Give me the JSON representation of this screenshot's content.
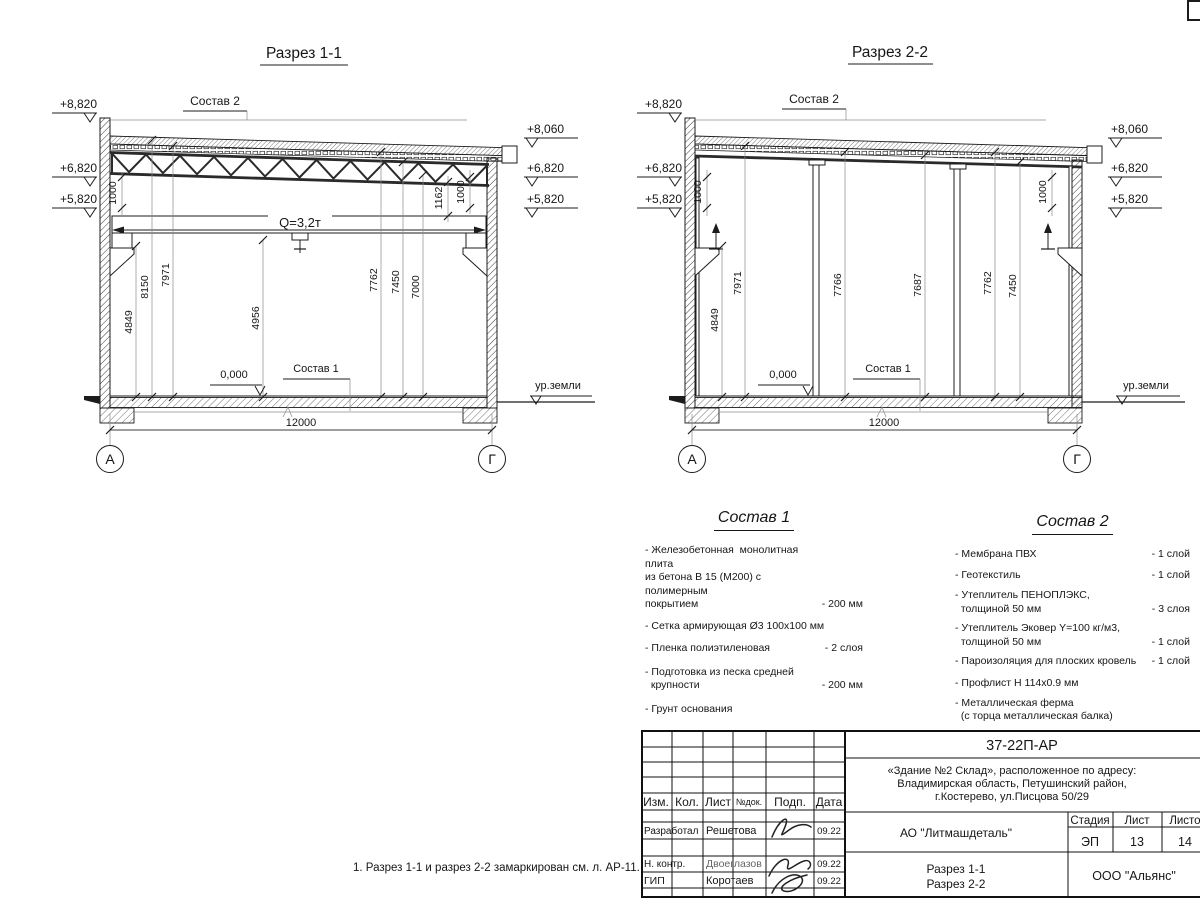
{
  "note": "1. Разрез 1-1 и разрез 2-2 замаркирован см. л. АР-11.",
  "s1": {
    "title": "Разрез 1-1",
    "elev": {
      "l1": "+8,820",
      "l2": "+6,820",
      "l3": "+5,820",
      "r1": "+8,060",
      "r2": "+6,820",
      "r3": "+5,820"
    },
    "labels": {
      "sostav2": "Состав 2",
      "sostav1": "Состав 1",
      "crane": "Q=3,2т",
      "zero": "0,000",
      "ground": "ур.земли",
      "span": "12000",
      "axis_a": "А",
      "axis_g": "Г"
    },
    "dims": {
      "wl": "1000",
      "wr1": "1162",
      "wr2": "1000",
      "h1": "4849",
      "h2": "8150",
      "h3": "7971",
      "h4": "4956",
      "h5": "7762",
      "h6": "7450",
      "h7": "7000"
    }
  },
  "s2": {
    "title": "Разрез 2-2",
    "elev": {
      "l1": "+8,820",
      "l2": "+6,820",
      "l3": "+5,820",
      "r1": "+8,060",
      "r2": "+6,820",
      "r3": "+5,820"
    },
    "labels": {
      "sostav2": "Состав 2",
      "sostav1": "Состав 1",
      "zero": "0,000",
      "ground": "ур.земли",
      "span": "12000",
      "axis_a": "А",
      "axis_g": "Г"
    },
    "dims": {
      "wl": "1000",
      "wr": "1000",
      "h1": "4849",
      "h2": "7971",
      "h3": "7766",
      "h4": "7687",
      "h5": "7762",
      "h6": "7450"
    }
  },
  "sostav1": {
    "title": "Состав 1",
    "items": [
      {
        "text": "- Железобетонная  монолитная плита\nиз бетона В 15 (М200) с полимерным\nпокрытием",
        "value": "- 200 мм"
      },
      {
        "text": "- Сетка армирующая Ø3 100х100 мм",
        "value": ""
      },
      {
        "text": "- Пленка полиэтиленовая",
        "value": "-  2 слоя"
      },
      {
        "text": "- Подготовка из песка средней\n  крупности",
        "value": "- 200 мм"
      },
      {
        "text": "- Грунт основания",
        "value": ""
      }
    ]
  },
  "sostav2": {
    "title": "Состав 2",
    "items": [
      {
        "text": "- Мембрана ПВХ",
        "value": "- 1 слой"
      },
      {
        "text": "- Геотекстиль",
        "value": "- 1 слой"
      },
      {
        "text": "- Утеплитель ПЕНОПЛЭКС,\n  толщиной 50 мм",
        "value": "- 3 слоя"
      },
      {
        "text": "- Утеплитель Эковер Y=100 кг/м3,\n  толщиной 50 мм",
        "value": "- 1 слой"
      },
      {
        "text": "- Пароизоляция для плоских кровель",
        "value": "- 1 слой"
      },
      {
        "text": "- Профлист Н 114х0.9 мм",
        "value": ""
      },
      {
        "text": "- Металлическая ферма\n  (с торца металлическая балка)",
        "value": ""
      }
    ]
  },
  "titleblock": {
    "code": "37-22П-АР",
    "object_lines": [
      "«Здание №2 Склад», расположенное по адресу:",
      "Владимирская область, Петушинский район,",
      "г.Костерево, ул.Писцова 50/29"
    ],
    "cols": {
      "izm": "Изм.",
      "kol": "Кол.",
      "list": "Лист",
      "ndoc": "№док.",
      "podp": "Подп.",
      "data": "Дата"
    },
    "rows": [
      {
        "role": "Разработал",
        "name": "Решетова",
        "date": "09.22"
      },
      {
        "role": "Н. контр.",
        "name": "Двоеглазов",
        "date": "09.22"
      },
      {
        "role": "ГИП",
        "name": "Коротаев",
        "date": "09.22"
      }
    ],
    "company": "АО \"Литмашдеталь\"",
    "stage_label": "Стадия",
    "sheet_label": "Лист",
    "sheets_label": "Листов",
    "stage": "ЭП",
    "sheet": "13",
    "sheets": "14",
    "sheet_title_lines": [
      "Разрез 1-1",
      "Разрез 2-2"
    ],
    "org": "ООО \"Альянс\""
  }
}
